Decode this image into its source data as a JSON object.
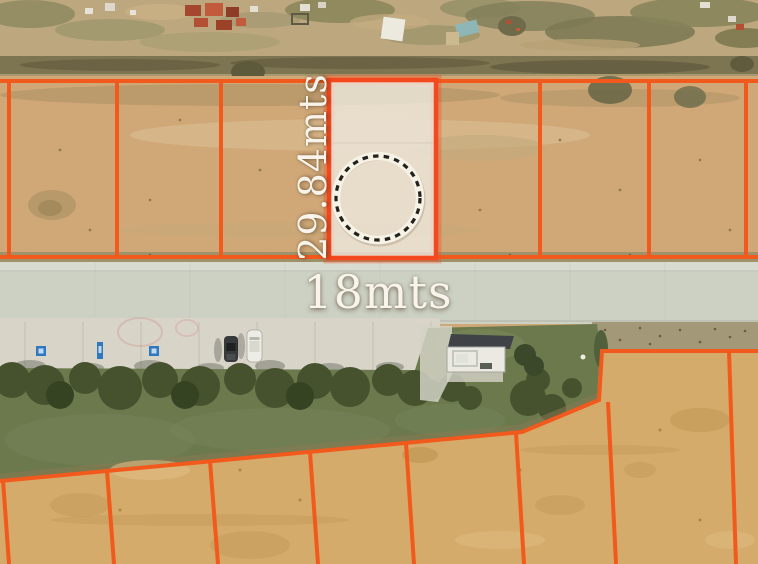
{
  "map": {
    "canvas": {
      "width": 758,
      "height": 564,
      "view": "satellite"
    },
    "parcel": {
      "depth_label": "29.84mts",
      "width_label": "18mts",
      "marker": "dashed-circle"
    },
    "colors": {
      "boundary_orange": "#f2591c",
      "highlight_border": "#f4481e",
      "highlight_fill": "rgba(237,232,222,0.8)",
      "marker_ring": "#f6f2e6",
      "marker_dash": "#23211b",
      "accessible_blue": "#2f78c0",
      "label_text": "#f8f4eb"
    },
    "icons": [
      {
        "name": "lot-marker-dashed-circle-icon"
      },
      {
        "name": "accessible-parking-icon"
      },
      {
        "name": "car-dark"
      },
      {
        "name": "car-white"
      }
    ]
  }
}
